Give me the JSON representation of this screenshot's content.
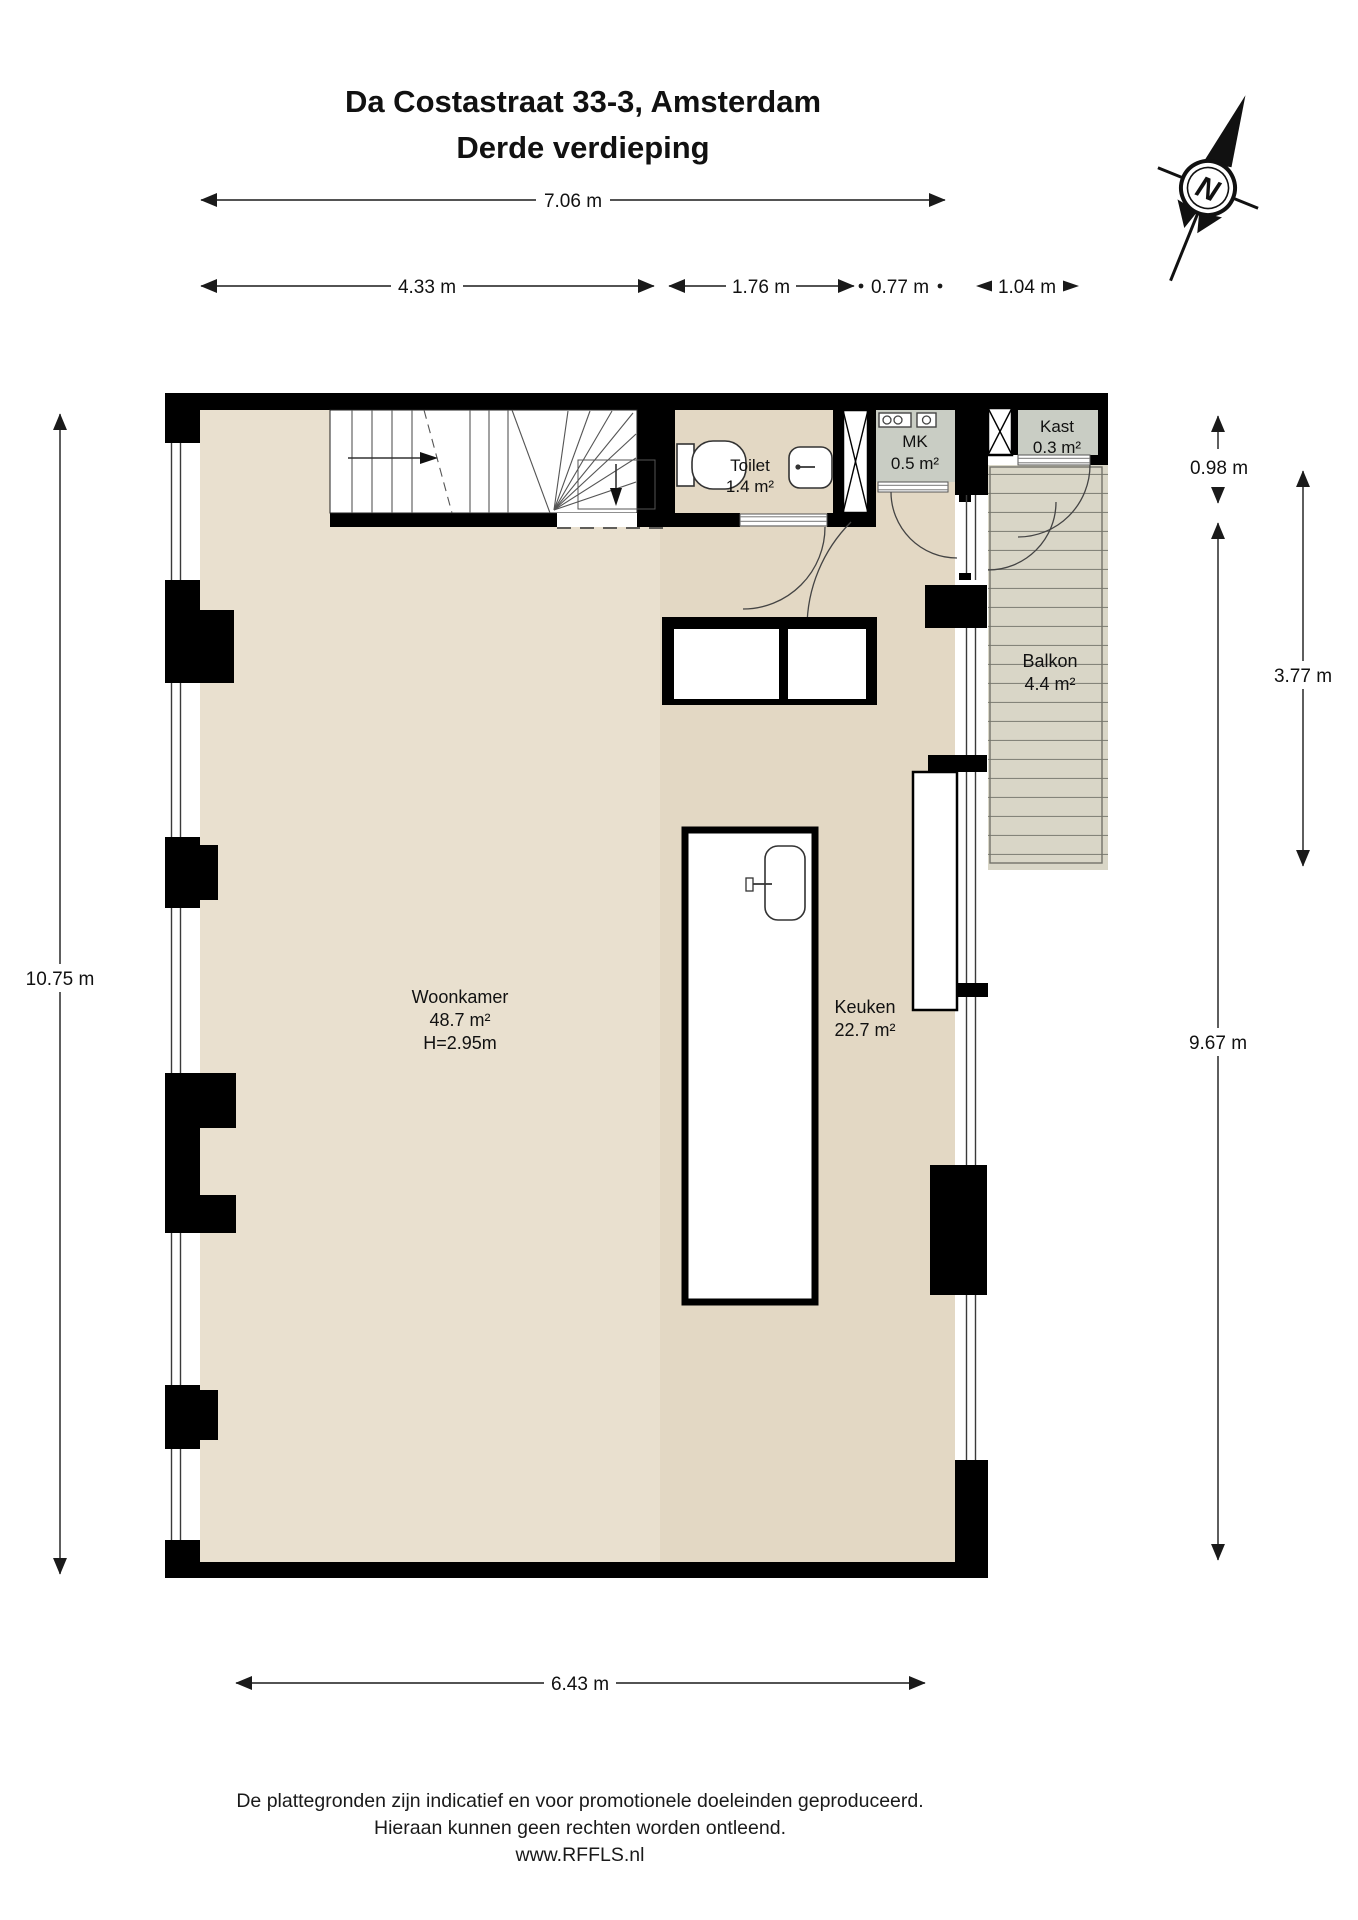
{
  "title": {
    "line1": "Da Costastraat 33-3, Amsterdam",
    "line2": "Derde verdieping"
  },
  "compass": {
    "north_label": "N"
  },
  "dimensions": {
    "top_total": "7.06 m",
    "top_segments": [
      "4.33 m",
      "1.76 m",
      "0.77 m",
      "1.04 m"
    ],
    "left_total": "10.75 m",
    "right_upper": "0.98 m",
    "right_main": "9.67 m",
    "right_balcony": "3.77 m",
    "bottom": "6.43 m"
  },
  "rooms": {
    "woonkamer": {
      "name": "Woonkamer",
      "area": "48.7 m²",
      "height_label": "H=2.95m"
    },
    "keuken": {
      "name": "Keuken",
      "area": "22.7 m²"
    },
    "toilet": {
      "name": "Toilet",
      "area": "1.4 m²"
    },
    "mk": {
      "name": "MK",
      "area": "0.5 m²"
    },
    "kast": {
      "name": "Kast",
      "area": "0.3 m²"
    },
    "balkon": {
      "name": "Balkon",
      "area": "4.4 m²"
    }
  },
  "footer": {
    "line1": "De plattegronden zijn indicatief en voor promotionele doeleinden geproduceerd.",
    "line2": "Hieraan kunnen geen rechten worden ontleend.",
    "line3": "www.RFFLS.nl"
  },
  "colors": {
    "wall": "#000000",
    "floor_living": "#e9e0cf",
    "floor_kitchen": "#e3d8c4",
    "cupboard_gray": "#c9cdc4",
    "balcony": "#d9d6c7",
    "dimension_lines": "#1a1a1a"
  }
}
